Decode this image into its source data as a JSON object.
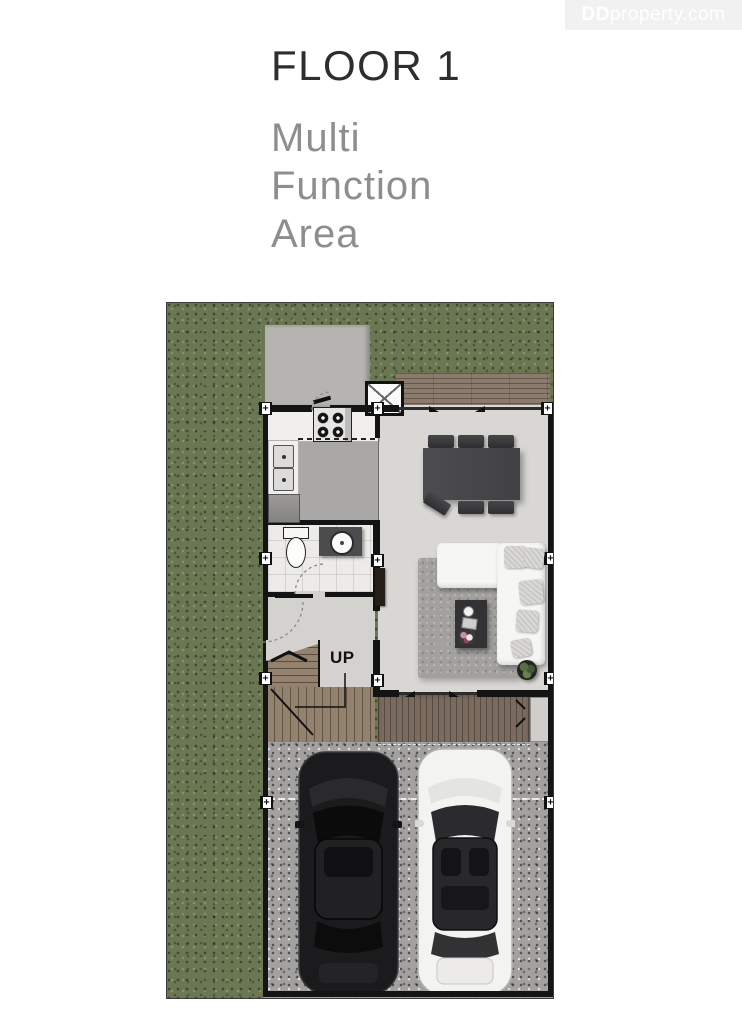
{
  "watermark": {
    "brand_bold": "DD",
    "brand_rest": "property.com"
  },
  "header": {
    "title": "FLOOR 1",
    "subtitle_lines": [
      "Multi",
      "Function",
      "Area"
    ]
  },
  "floor_plan": {
    "up_label": "UP"
  },
  "colors": {
    "title_text": "#2e2e2e",
    "subtitle_text": "#8e8e8e",
    "watermark_bg": "#f1f1f1",
    "watermark_text": "#ffffff",
    "grass": "#6a7752",
    "gravel": "#a2a19f",
    "deck_wood": "#8b7b6d",
    "porch_wood": "#7a6b5e",
    "stair_wood": "#93826e",
    "wall": "#141414",
    "floor_living": "#d8d7d4",
    "floor_kitchen": "#a9a8a6",
    "bath_tile": "#ecebe9",
    "concrete": "#b5b4b1",
    "table": "#48484a",
    "sofa": "#f6f6f5",
    "rug": "#a3a19e",
    "car_black": "#1b1b1d",
    "car_white": "#f3f3f2"
  }
}
